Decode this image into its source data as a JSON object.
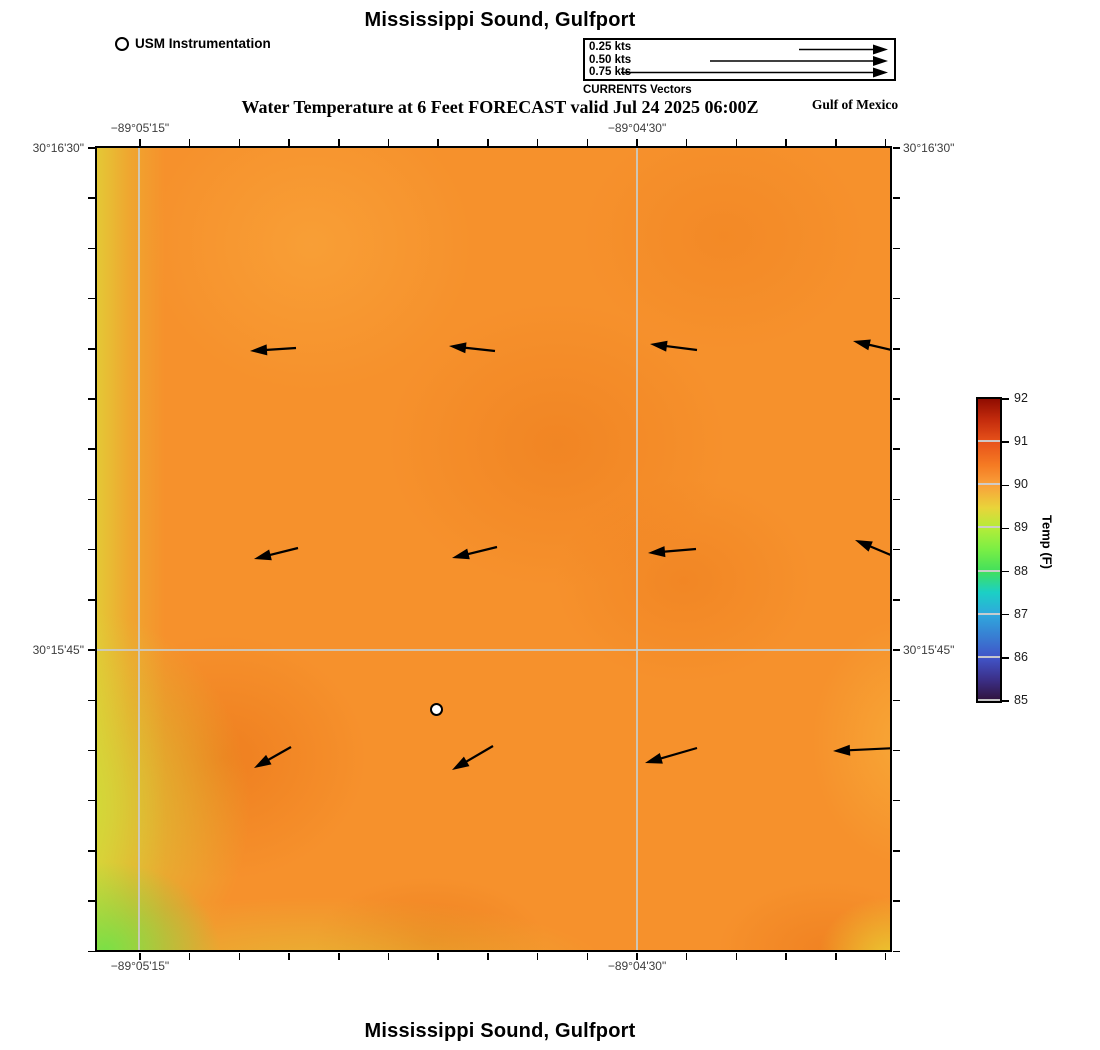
{
  "header": {
    "title": "Mississippi Sound, Gulfport",
    "station_legend": {
      "label": "USM Instrumentation"
    },
    "vector_legend": {
      "entries": [
        {
          "label": "0.25 kts",
          "speed_kts": 0.25
        },
        {
          "label": "0.50 kts",
          "speed_kts": 0.5
        },
        {
          "label": "0.75 kts",
          "speed_kts": 0.75
        }
      ],
      "caption": "CURRENTS Vectors",
      "scale_px_per_kt": 356
    },
    "subtitle": "Water Temperature at 6 Feet FORECAST valid Jul 24 2025 06:00Z",
    "region_label": "Gulf of Mexico"
  },
  "footer": {
    "title": "Mississippi Sound, Gulfport"
  },
  "colors": {
    "base_field_orange": "#f6912c",
    "dark_blob_orange": "#ec7a1e",
    "edge_yellow": "#e2ce37",
    "corner_green": "#8ee24e",
    "gridline_gray": "#cbcbc3",
    "vector_black": "#000000"
  },
  "chart_data": {
    "type": "heatmap",
    "title": "Mississippi Sound, Gulfport",
    "subtitle": "Water Temperature at 6 Feet FORECAST valid Jul 24 2025 06:00Z",
    "region_label": "Gulf of Mexico",
    "x_axis": {
      "ticks": [
        {
          "label": "−89°05'15\"",
          "frac": 0.0542,
          "grid": true
        },
        {
          "label": "−89°04'30\"",
          "frac": 0.681,
          "grid": true
        }
      ],
      "minor_tick_count": 16
    },
    "y_axis": {
      "ticks": [
        {
          "label": "30°16'30\"",
          "frac": 0.0,
          "grid": false
        },
        {
          "label": "30°15'45\"",
          "frac": 0.626,
          "grid": true
        }
      ],
      "minor_tick_count": 17
    },
    "colorbar": {
      "label": "Temp (F)",
      "min": 85,
      "max": 92,
      "tick_labels": [
        85,
        86,
        87,
        88,
        89,
        90,
        91,
        92
      ],
      "gradient_stops": [
        [
          "#30123b",
          0
        ],
        [
          "#3b2f87",
          7
        ],
        [
          "#4154c8",
          14.3
        ],
        [
          "#2fa8dd",
          28.6
        ],
        [
          "#1bd0c5",
          36
        ],
        [
          "#41e05c",
          42.9
        ],
        [
          "#79ee45",
          50
        ],
        [
          "#b2ed39",
          57.1
        ],
        [
          "#e9d43a",
          64
        ],
        [
          "#f9a13b",
          71.4
        ],
        [
          "#f57b23",
          78
        ],
        [
          "#e8531a",
          85.7
        ],
        [
          "#c42c0d",
          93
        ],
        [
          "#900c00",
          100
        ]
      ]
    },
    "vectors": [
      {
        "head": [
          153,
          203
        ],
        "tail": [
          199,
          200
        ]
      },
      {
        "head": [
          352,
          198
        ],
        "tail": [
          398,
          203
        ]
      },
      {
        "head": [
          553,
          196
        ],
        "tail": [
          600,
          202
        ]
      },
      {
        "head": [
          756,
          193
        ],
        "tail": [
          799,
          203
        ]
      },
      {
        "head": [
          157,
          411
        ],
        "tail": [
          201,
          400
        ]
      },
      {
        "head": [
          355,
          410
        ],
        "tail": [
          400,
          399
        ]
      },
      {
        "head": [
          551,
          405
        ],
        "tail": [
          599,
          401
        ]
      },
      {
        "head": [
          758,
          392
        ],
        "tail": [
          801,
          410
        ]
      },
      {
        "head": [
          157,
          620
        ],
        "tail": [
          194,
          599
        ]
      },
      {
        "head": [
          355,
          622
        ],
        "tail": [
          396,
          598
        ]
      },
      {
        "head": [
          548,
          615
        ],
        "tail": [
          600,
          600
        ]
      },
      {
        "head": [
          736,
          603
        ],
        "tail": [
          800,
          600
        ]
      }
    ],
    "station": {
      "x": 340,
      "y": 562,
      "label": "USM Instrumentation"
    },
    "field_samples_f": [
      {
        "x_frac": 0.02,
        "y_frac": 0.98,
        "temp": 88.4
      },
      {
        "x_frac": 0.02,
        "y_frac": 0.5,
        "temp": 89.3
      },
      {
        "x_frac": 0.03,
        "y_frac": 0.08,
        "temp": 89.5
      },
      {
        "x_frac": 0.3,
        "y_frac": 0.97,
        "temp": 89.6
      },
      {
        "x_frac": 0.99,
        "y_frac": 0.98,
        "temp": 89.6
      },
      {
        "x_frac": 0.5,
        "y_frac": 0.5,
        "temp": 90.2
      },
      {
        "x_frac": 0.58,
        "y_frac": 0.37,
        "temp": 90.5
      },
      {
        "x_frac": 0.17,
        "y_frac": 0.76,
        "temp": 90.6
      },
      {
        "x_frac": 0.79,
        "y_frac": 0.11,
        "temp": 90.4
      },
      {
        "x_frac": 0.74,
        "y_frac": 0.54,
        "temp": 90.5
      }
    ]
  }
}
